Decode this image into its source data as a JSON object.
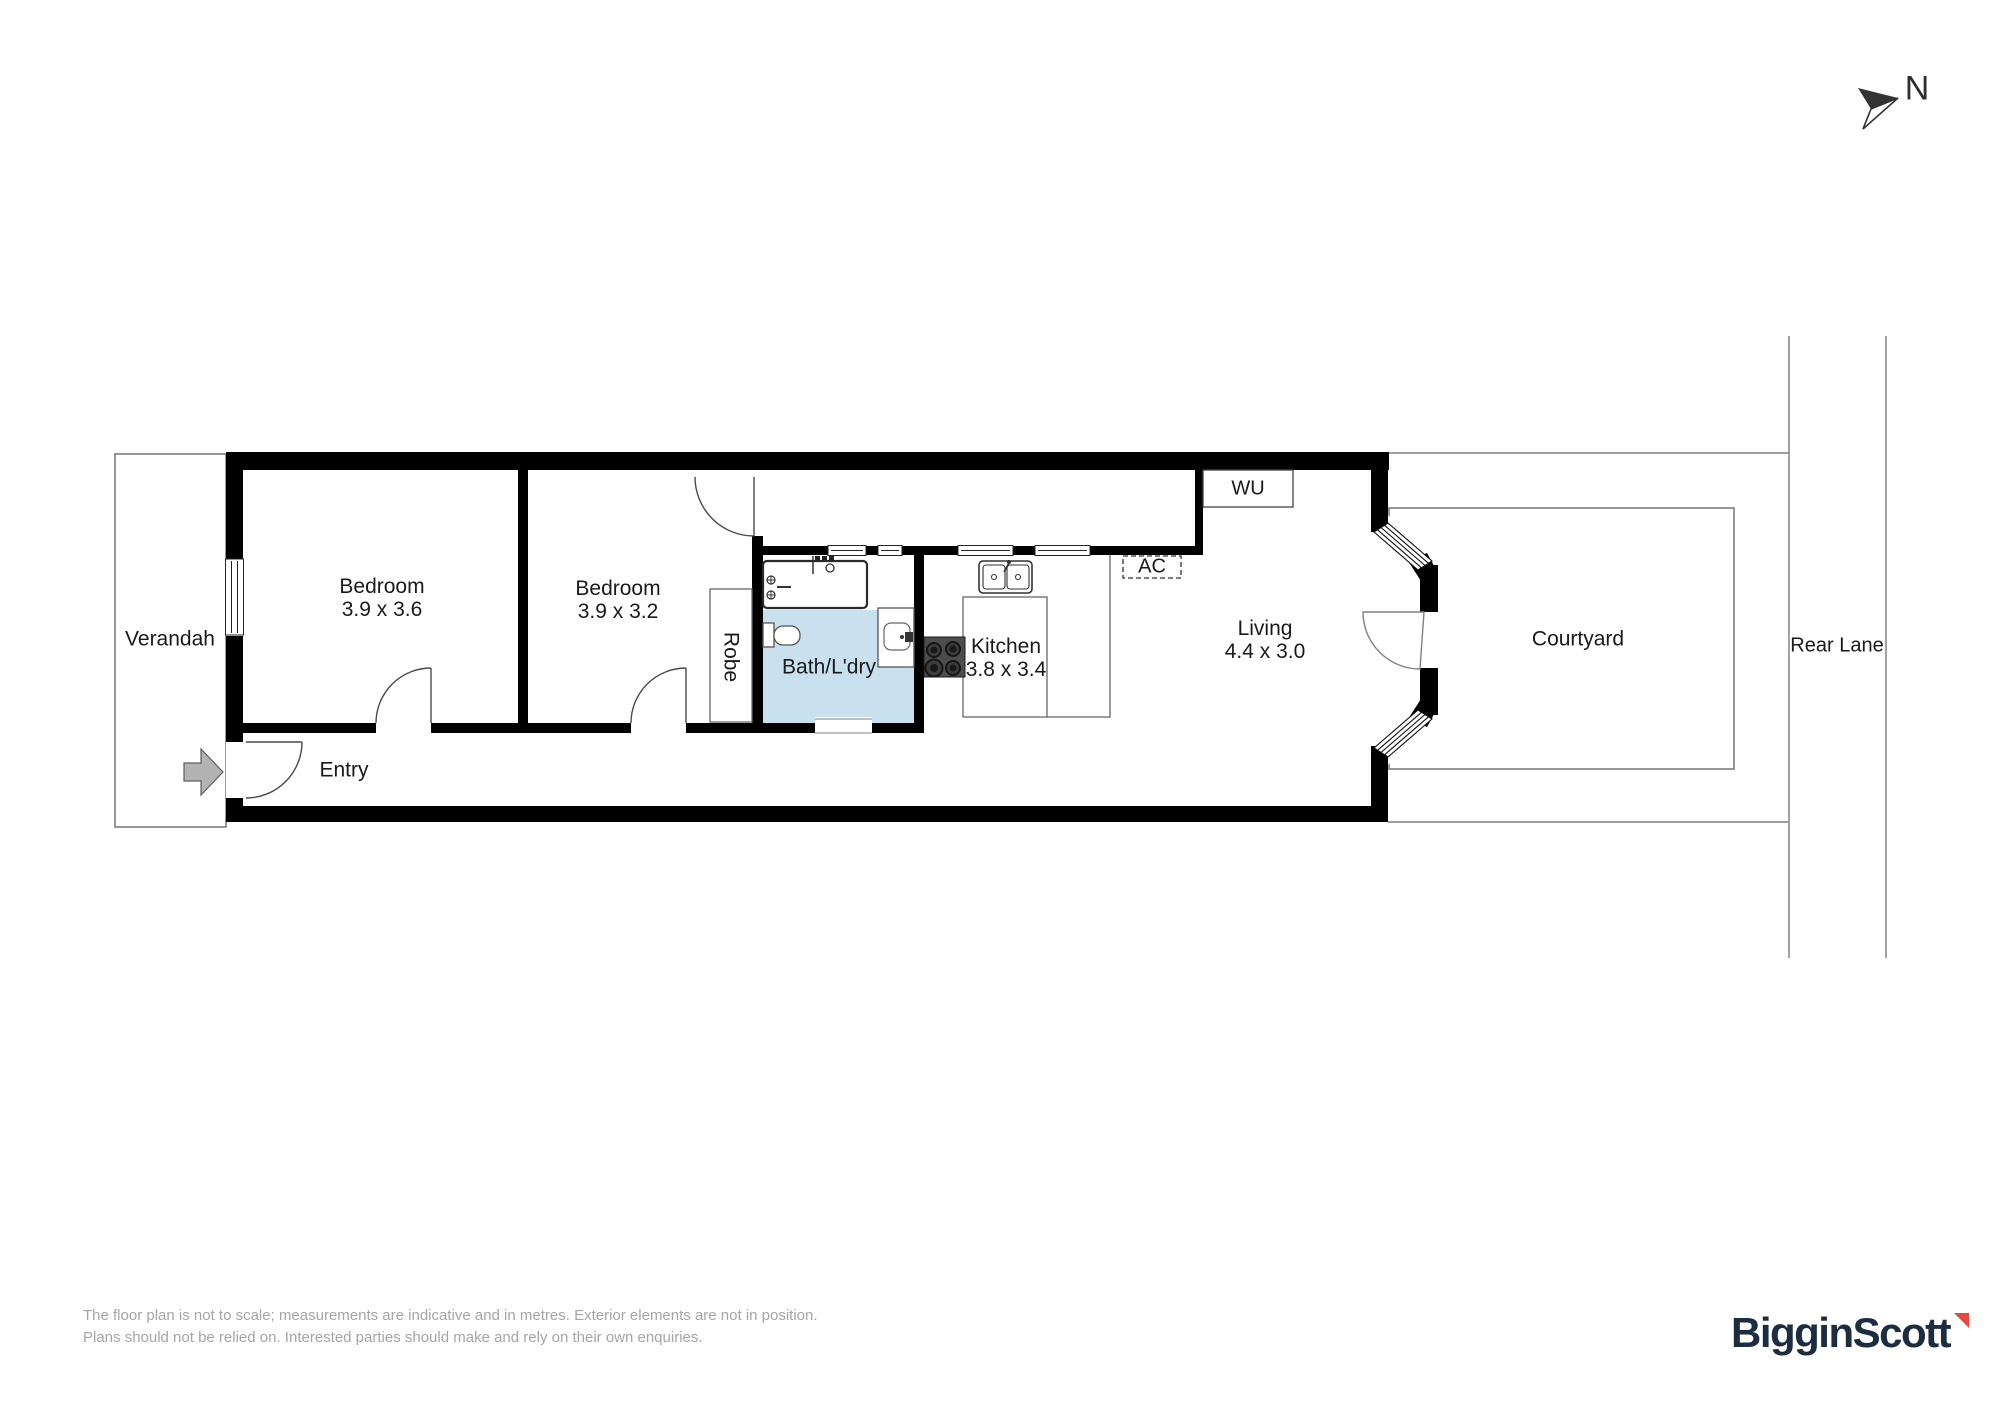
{
  "plan": {
    "north_label": "N",
    "rooms": {
      "verandah": {
        "name": "Verandah"
      },
      "bedroom1": {
        "name": "Bedroom",
        "dims": "3.9 x 3.6"
      },
      "bedroom2": {
        "name": "Bedroom",
        "dims": "3.9 x 3.2"
      },
      "robe": {
        "name": "Robe"
      },
      "bath_laundry": {
        "name": "Bath/L'dry"
      },
      "kitchen": {
        "name": "Kitchen",
        "dims": "3.8 x 3.4"
      },
      "living": {
        "name": "Living",
        "dims": "4.4 x 3.0"
      },
      "entry": {
        "name": "Entry"
      },
      "wu": {
        "name": "WU"
      },
      "ac": {
        "name": "AC"
      },
      "courtyard": {
        "name": "Courtyard"
      },
      "rear_lane": {
        "name": "Rear Lane"
      }
    },
    "icons": [
      "north-arrow-icon",
      "entry-direction-arrow-icon",
      "bathtub-icon",
      "toilet-icon",
      "vanity-basin-icon",
      "kitchen-sink-icon",
      "cooktop-icon",
      "window-icon",
      "door-swing-icon"
    ]
  },
  "disclaimer": {
    "line1": "The floor plan is not to scale; measurements are indicative and in metres. Exterior elements are not in position.",
    "line2": "Plans should not be relied on. Interested parties should make and rely on their own enquiries."
  },
  "brand": {
    "name": "BigginScott"
  },
  "colors": {
    "wall": "#000000",
    "bath_fill": "#c9e0ee",
    "boundary_gray": "#7d7d7d",
    "logo_navy": "#1c2c41",
    "logo_red": "#e8473e",
    "disclaimer_gray": "#a5a5a5",
    "entry_arrow_gray": "#b3b3b3"
  }
}
